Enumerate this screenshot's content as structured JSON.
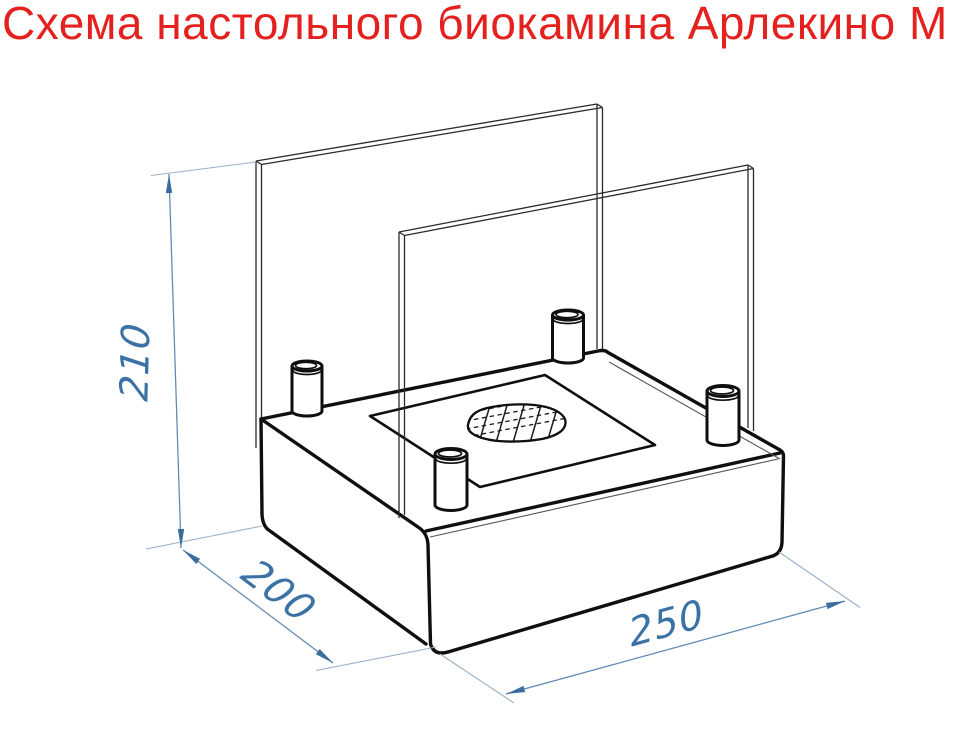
{
  "title": "Схема настольного биокамина Арлекино М",
  "drawing": {
    "dimensions": {
      "height_mm": "210",
      "depth_mm": "200",
      "width_mm": "250"
    },
    "colors": {
      "title_red": "#e3211e",
      "dimension_blue": "#3a72a5",
      "line_black": "#0f0f0f"
    }
  }
}
